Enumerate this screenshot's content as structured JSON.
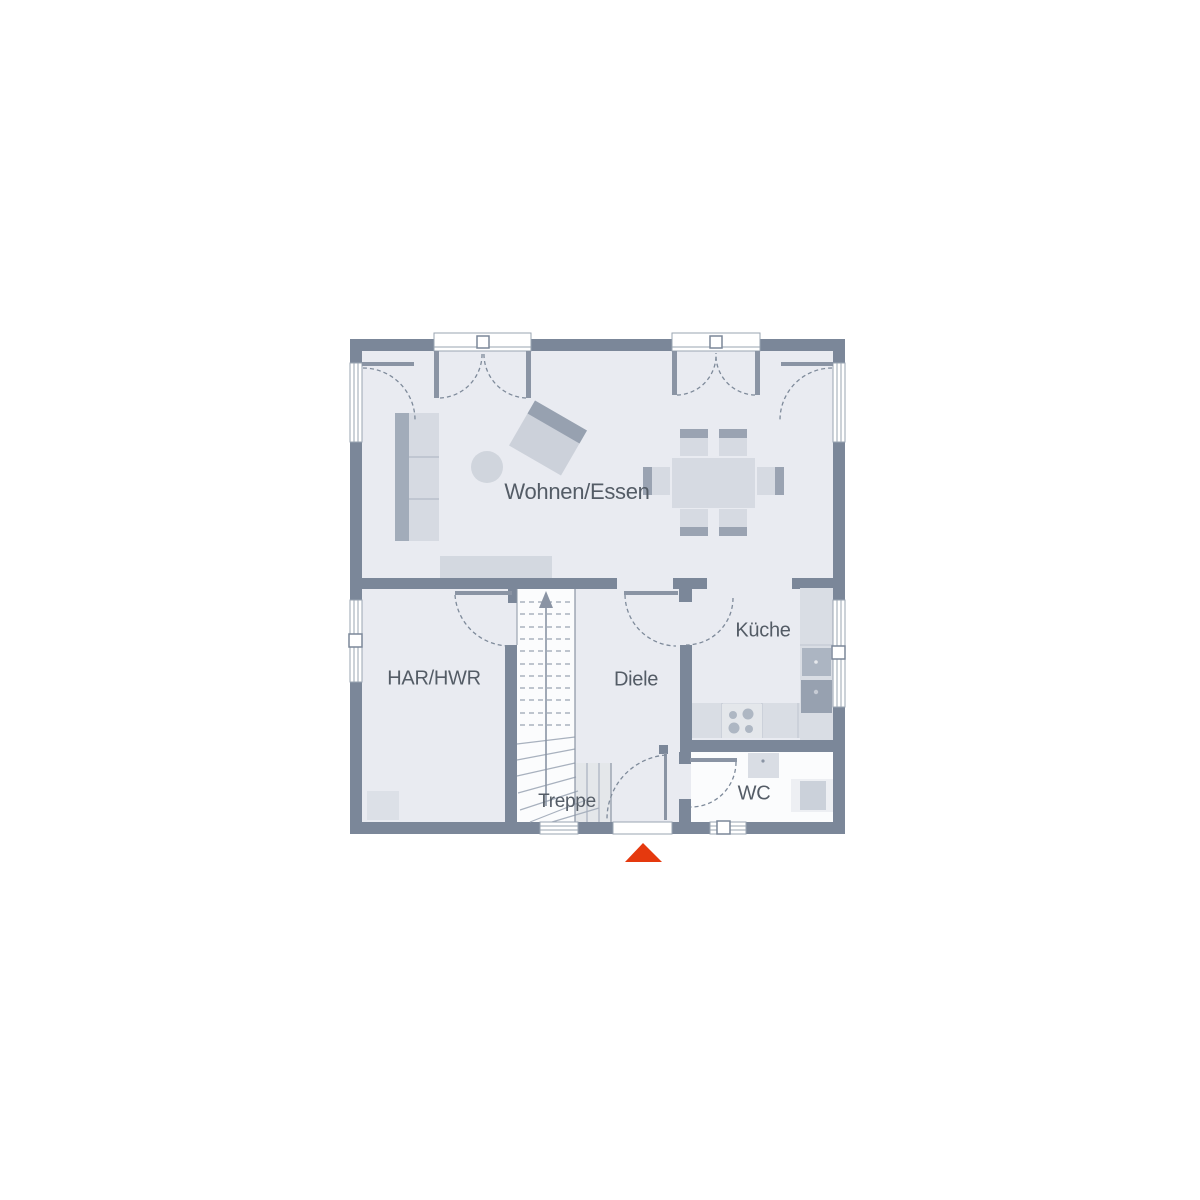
{
  "floorplan": {
    "title": "Erdgeschoss Grundriss",
    "rooms": [
      {
        "id": "wohnen-essen",
        "label": "Wohnen/Essen"
      },
      {
        "id": "har-hwr",
        "label": "HAR/HWR"
      },
      {
        "id": "diele",
        "label": "Diele"
      },
      {
        "id": "kueche",
        "label": "Küche"
      },
      {
        "id": "treppe",
        "label": "Treppe"
      },
      {
        "id": "wc",
        "label": "WC"
      }
    ],
    "stairs": {
      "direction": "up"
    },
    "entrance": {
      "marker": "entrance-arrow",
      "side": "south"
    },
    "colors": {
      "wall": "#7B8799",
      "floor": "#E9EBF1",
      "floor_light": "#FBFCFD",
      "line": "#8A94A4",
      "swing_dash": "#7E8A9A",
      "furniture": "#D6DAE2",
      "furniture_dark": "#A2ACBA",
      "furniture_darker": "#97A1B0",
      "label_text": "#545C66",
      "entrance_arrow": "#E5390E"
    }
  }
}
